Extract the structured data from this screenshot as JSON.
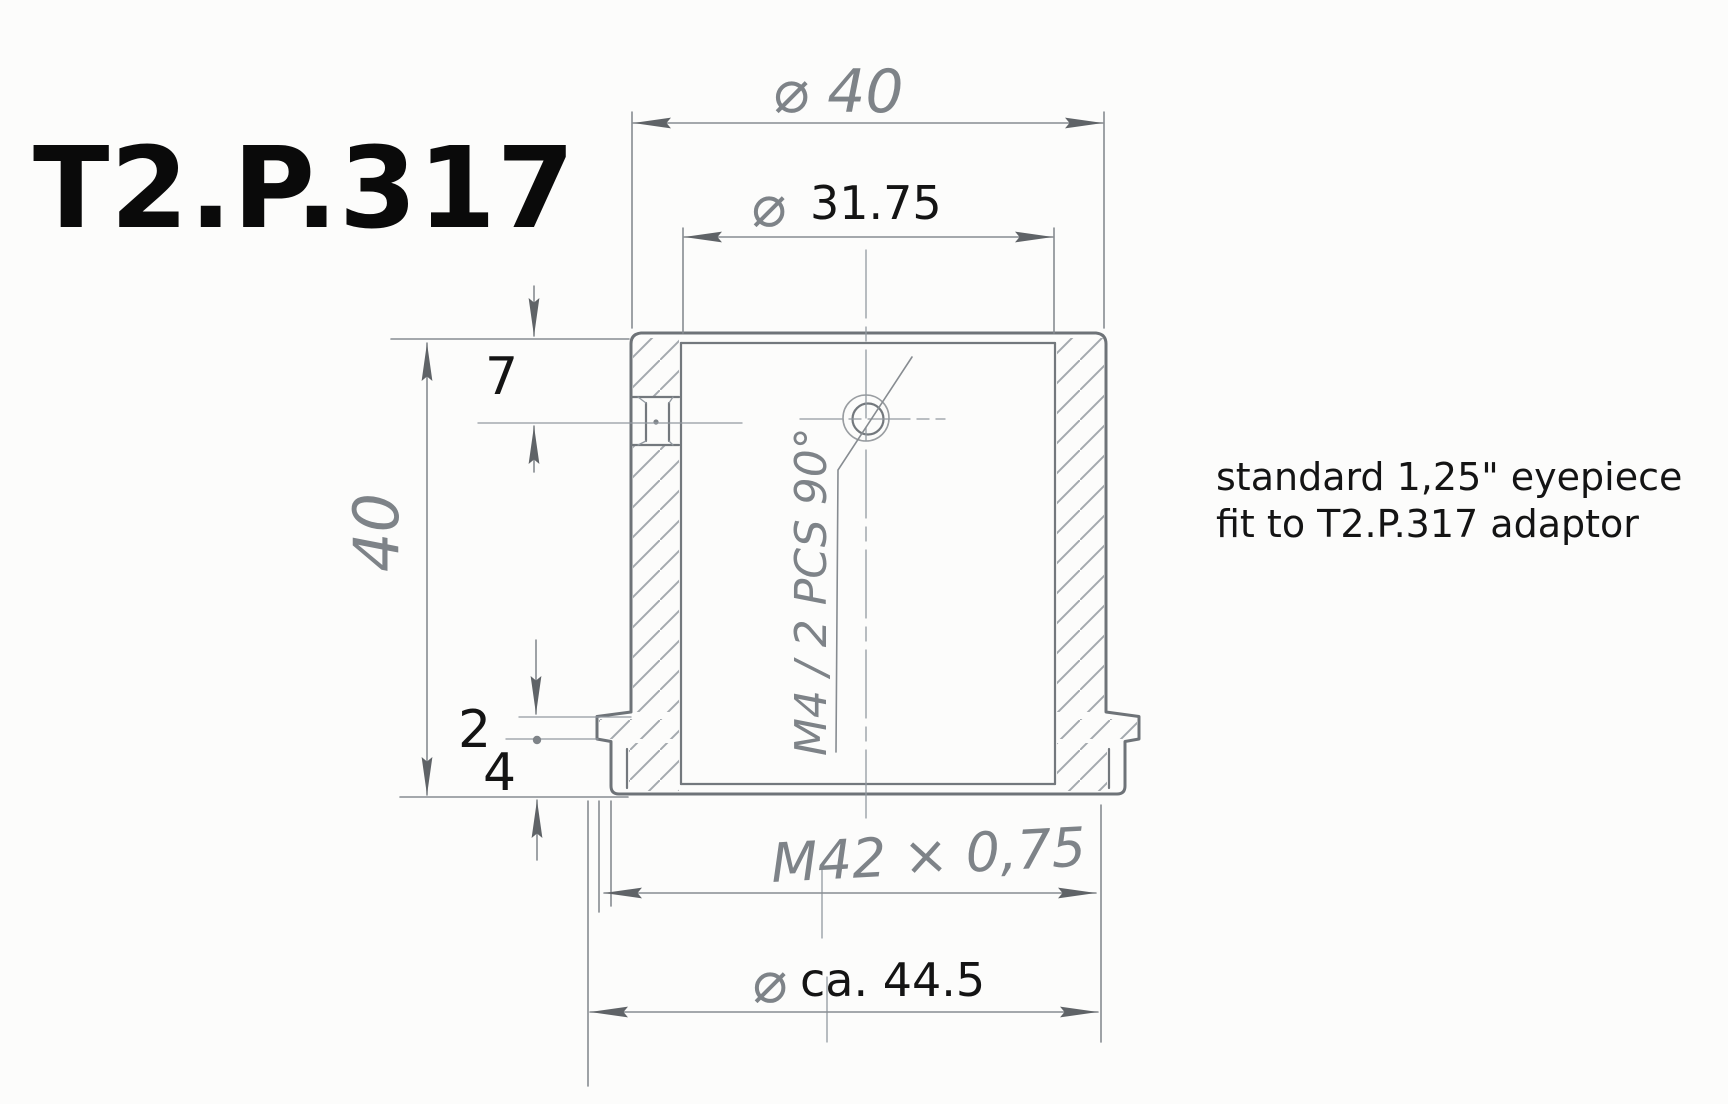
{
  "title": "T2.P.317",
  "note": {
    "line1": "standard 1,25\" eyepiece",
    "line2": "fit to T2.P.317 adaptor"
  },
  "dims": {
    "od_top": {
      "text": "⌀ 40"
    },
    "bore": {
      "symbol": "⌀",
      "value": "31.75"
    },
    "height": {
      "text": "40"
    },
    "screw_offset": {
      "text": "7"
    },
    "step": {
      "text": "2"
    },
    "flange": {
      "text": "4"
    },
    "thread": {
      "text": "M42 × 0,75"
    },
    "od_bottom": {
      "symbol": "⌀",
      "value": "ca. 44.5"
    },
    "screw_spec": {
      "text": "M4 / 2 PCS 90°"
    }
  },
  "colors": {
    "paper": "#fcfcfb",
    "pencil": "#7e8388",
    "outline": "#6e7378",
    "arrow": "#5f6367",
    "ink": "#141414"
  }
}
